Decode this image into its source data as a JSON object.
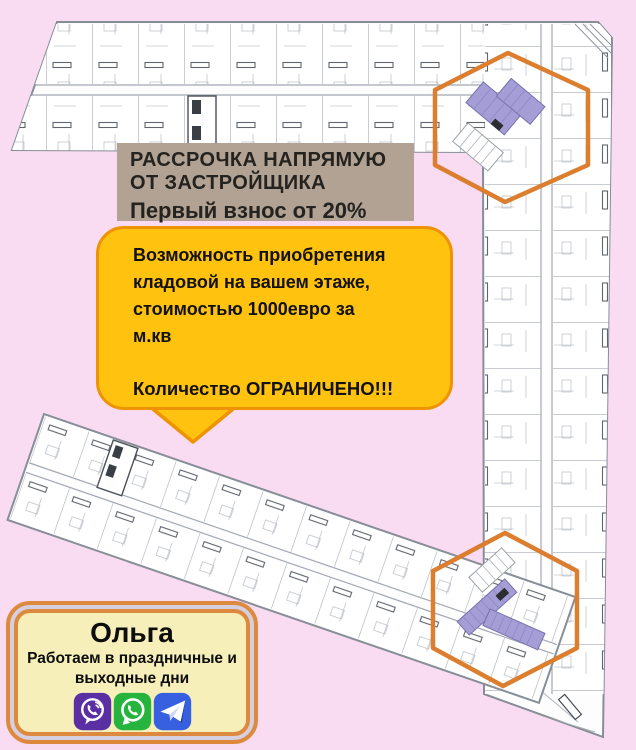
{
  "promo": {
    "line1": "РАССРОЧКА НАПРЯМУЮ",
    "line2": "ОТ ЗАСТРОЙЩИКА",
    "line3": "Первый взнос от 20%"
  },
  "bubble": {
    "lines": [
      "Возможность приобретения",
      "кладовой на вашем этаже,",
      "стоимостью 1000евро за",
      "м.кв"
    ],
    "warning": "Количество ОГРАНИЧЕНО!!!"
  },
  "contact": {
    "name": "Ольга",
    "note1": "Работаем в праздничные и",
    "note2": "выходные дни",
    "messengers": [
      "viber",
      "whatsapp",
      "telegram"
    ]
  },
  "colors": {
    "bg": "#fadcf2",
    "plan_line": "#878e97",
    "highlight": "#dc7e2f",
    "storage": "#a49dd6",
    "storage_edge": "#7670ae",
    "promo_bg": "#b2a294",
    "promo_text": "#24231f",
    "bubble_fill": "#ffc20e",
    "bubble_border": "#ee9303",
    "card_border": "#de8a3e",
    "card_gap": "#d5cfe0",
    "card_fill": "#f7efb9",
    "viber": "#5b2fa4",
    "whatsapp": "#27b43e",
    "telegram": "#3760e0"
  }
}
